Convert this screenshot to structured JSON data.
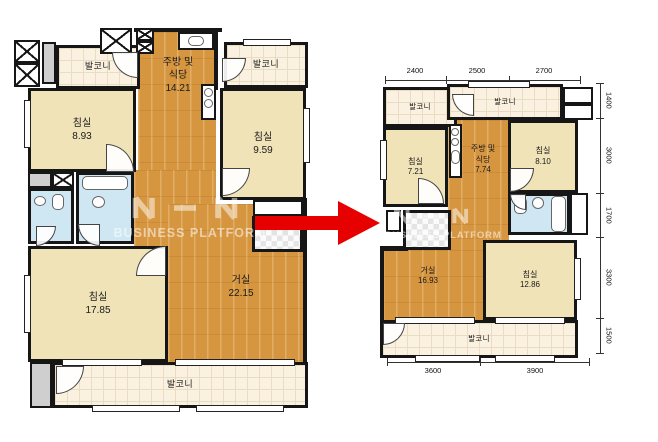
{
  "watermark": {
    "brand": "BUSINESS PLATFORM"
  },
  "left_plan": {
    "balcony_top_left": "발코니",
    "balcony_top_right": "발코니",
    "balcony_bottom": "발코니",
    "kitchen": {
      "l1": "주방 및",
      "l2": "식당",
      "area": "14.21"
    },
    "bedroom_top_left": {
      "label": "침실",
      "area": "8.93"
    },
    "bedroom_top_right": {
      "label": "침실",
      "area": "9.59"
    },
    "bedroom_bottom_left": {
      "label": "침실",
      "area": "17.85"
    },
    "living": {
      "label": "거실",
      "area": "22.15"
    }
  },
  "right_plan": {
    "balcony_top_left": "발코니",
    "balcony_top_mid": "발코니",
    "balcony_bottom": "발코니",
    "kitchen": {
      "l1": "주방 및",
      "l2": "식당",
      "area": "7.74"
    },
    "bedroom_1": {
      "label": "침실",
      "area": "7.21"
    },
    "bedroom_2": {
      "label": "침실",
      "area": "8.10"
    },
    "bedroom_3": {
      "label": "침실",
      "area": "12.86"
    },
    "living": {
      "label": "거실",
      "area": "16.93"
    },
    "dims_top": [
      "2400",
      "2500",
      "2700"
    ],
    "dims_right": [
      "1400",
      "3000",
      "1700",
      "3300",
      "1500"
    ],
    "dims_bottom": [
      "3600",
      "3900"
    ]
  },
  "colors": {
    "wood_floor": "#d6953f",
    "bedroom_floor": "#f0e3b8",
    "balcony_floor": "#faf1e0",
    "bath_floor": "#cfe7f2",
    "wall": "#161616",
    "arrow": "#e60000"
  }
}
